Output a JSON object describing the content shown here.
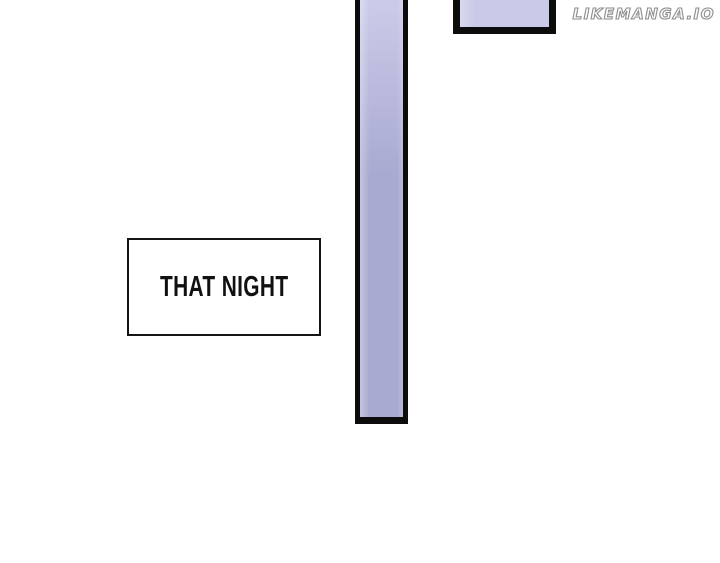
{
  "watermark": {
    "text": "LIKEMANGA.IO"
  },
  "caption_box": {
    "text": "THAT NIGHT"
  },
  "colors": {
    "background": "#ffffff",
    "outline": "#0c0c0c",
    "pole_fill_top": "#cbcbe9",
    "pole_fill_bottom": "#a9aad1",
    "panel_fill": "#c9c9e8",
    "caption_border": "#141414",
    "caption_fill": "#ffffff",
    "caption_text": "#111111",
    "watermark_outline": "#8f8f8f",
    "watermark_fill": "#ffffff"
  }
}
